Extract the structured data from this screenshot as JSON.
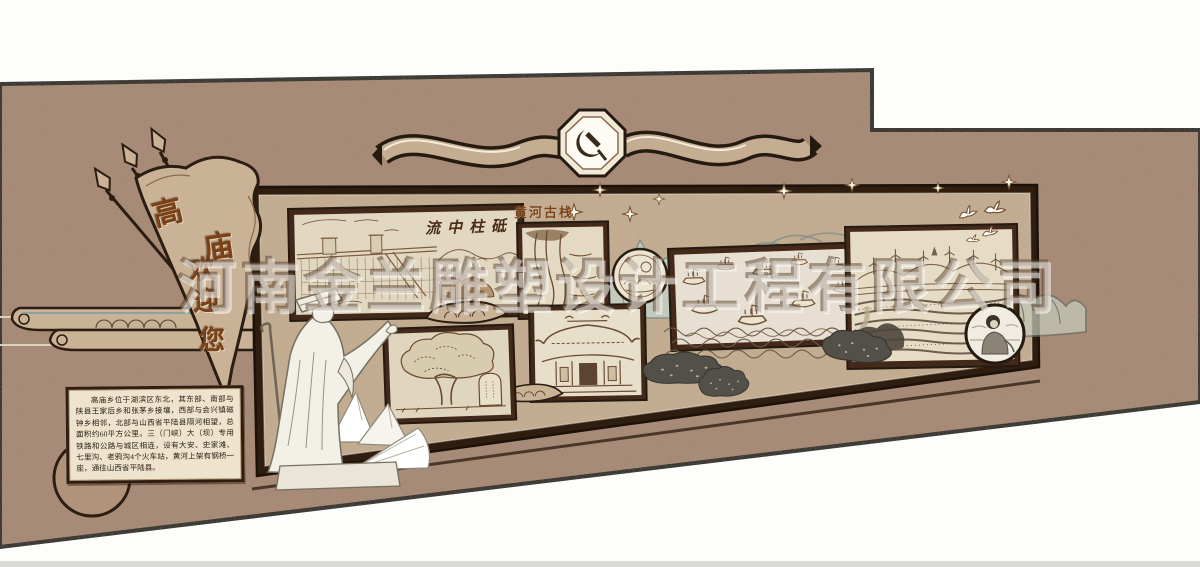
{
  "watermark": {
    "text": "河南金兰雕塑设计工程有限公司"
  },
  "pennant": {
    "text": "高庙欢迎您",
    "chars": [
      "高",
      "庙",
      "欢",
      "迎",
      "您"
    ]
  },
  "header_banner": {
    "emblem": "party-emblem-hammer-sickle-icon",
    "shape": "ribbon-scroll"
  },
  "panels": {
    "dam": {
      "title": "流中柱砥",
      "theme": "sanmenxia-dam-engraving"
    },
    "plank_road": {
      "title": "黄河古栈",
      "theme": "yellow-river-cliff-plank-road-engraving"
    },
    "boats": {
      "theme": "ancient-boats-fleet-engraving"
    },
    "temple": {
      "theme": "temple-gate-engraving"
    },
    "tree": {
      "theme": "ancient-tree-and-stele-engraving"
    },
    "landscape": {
      "theme": "wind-turbines-terraced-fields-engraving"
    },
    "medallion_scenery": {
      "theme": "round-landscape-medallion"
    },
    "medallion_person": {
      "theme": "round-portrait-medallion"
    }
  },
  "intro": {
    "text": "高庙乡位于湖滨区东北，其东部、南部与陕县王家后乡和张茅乡接壤，西部与会兴镇磁钟乡相邻，北部与山西省平陆县隔河相望，总面积约60平方公里。三（门峡）大（坝）专用铁路和公路与城区相连，设有大安、史家滩、七里沟、老鸦沟4个火车站，黄河上架有钢桥一座，通往山西省平陆县。"
  },
  "decor": {
    "statue": "robed-official-statue",
    "birds": "white-doves",
    "sparkles": "four-point-stars",
    "clouds": "auspicious-cloud-scrolls",
    "mountains": "line-art-mountain-silhouettes"
  },
  "colors": {
    "wall": "#a5866f",
    "board": "#c3ab8d",
    "frame_dark": "#43291a",
    "outline_ink": "#241a10",
    "panel_cream": "#e2d8c2",
    "engraving": "#6b4a2e",
    "calligraphy": "#7a4016",
    "teal_accent": "#7fa39a",
    "background": "#ffffff"
  }
}
